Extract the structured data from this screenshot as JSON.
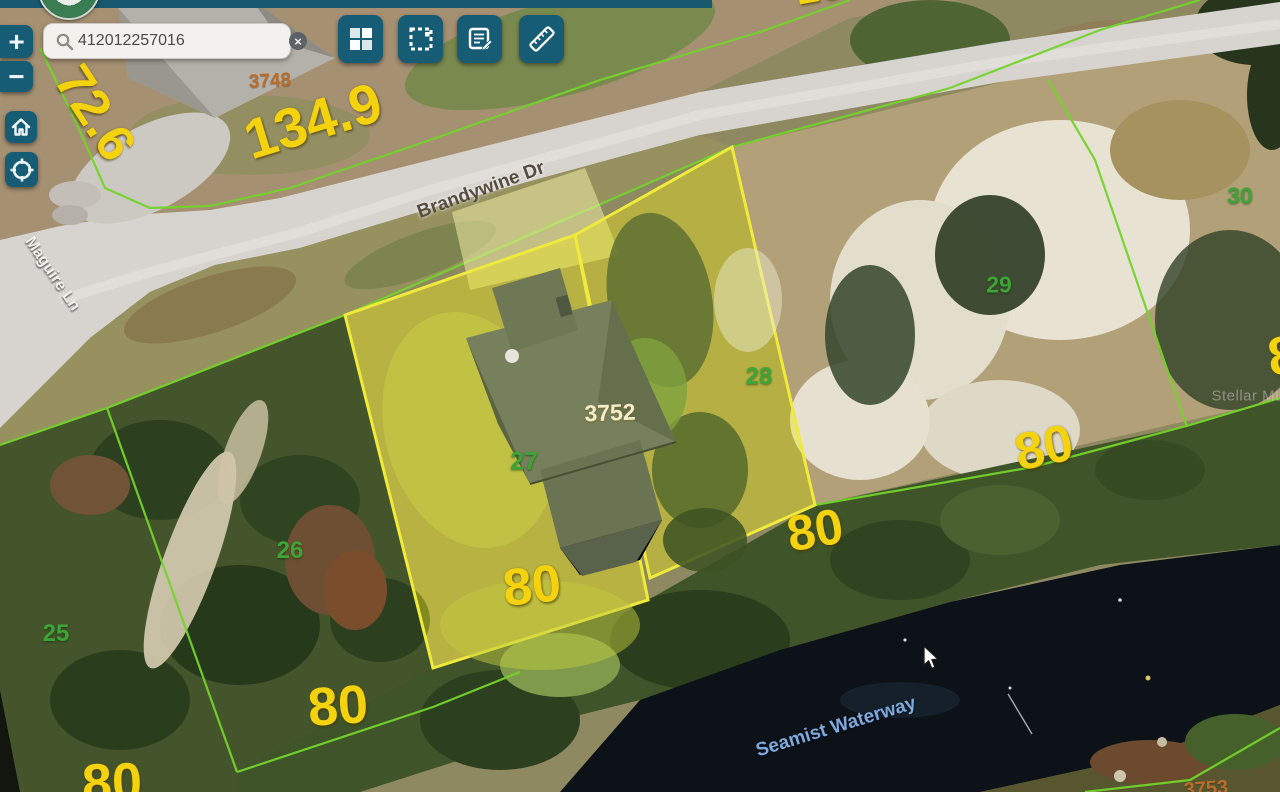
{
  "ui": {
    "search": {
      "value": "412012257016",
      "placeholder": "",
      "clear_glyph": "×"
    },
    "map_controls": {
      "zoom_in": "+",
      "zoom_out": "−"
    },
    "colors": {
      "accent_teal": "#175c75",
      "parcel_line_green": "#74d32c",
      "selection_yellow": "#f0ea3c",
      "dimension_yellow": "#f4d20d"
    }
  },
  "map": {
    "selected_parcel_id": "3752",
    "annotations": [
      {
        "name": "dimension-72-6",
        "text": "72.6",
        "x": 95,
        "y": 113,
        "rot": 57,
        "size": 52,
        "cls": "dim"
      },
      {
        "name": "dimension-134-9",
        "text": "134.9",
        "x": 313,
        "y": 121,
        "rot": -17,
        "size": 56,
        "cls": "dim"
      },
      {
        "name": "dimension-16-partial",
        "text": "16",
        "x": 818,
        "y": -13,
        "rot": -10,
        "size": 42,
        "cls": "dim"
      },
      {
        "name": "parcel-id-3748",
        "text": "3748",
        "x": 270,
        "y": 81,
        "rot": -3,
        "size": 19,
        "cls": "pid"
      },
      {
        "name": "street-brandywine-dr",
        "text": "Brandywine Dr",
        "x": 481,
        "y": 190,
        "rot": -20,
        "size": 19,
        "cls": "street"
      },
      {
        "name": "street-maguire-ln",
        "text": "Maguire Ln",
        "x": 52,
        "y": 274,
        "rot": 56,
        "size": 16,
        "cls": "street-white"
      },
      {
        "name": "lot-25",
        "text": "25",
        "x": 56,
        "y": 634,
        "rot": 0,
        "size": 24,
        "cls": "lot"
      },
      {
        "name": "lot-26",
        "text": "26",
        "x": 290,
        "y": 551,
        "rot": 0,
        "size": 24,
        "cls": "lot"
      },
      {
        "name": "lot-27",
        "text": "27",
        "x": 524,
        "y": 462,
        "rot": 0,
        "size": 25,
        "cls": "lot"
      },
      {
        "name": "lot-28",
        "text": "28",
        "x": 759,
        "y": 377,
        "rot": 0,
        "size": 24,
        "cls": "lot"
      },
      {
        "name": "lot-29",
        "text": "29",
        "x": 999,
        "y": 285,
        "rot": 0,
        "size": 23,
        "cls": "lot"
      },
      {
        "name": "lot-30",
        "text": "30",
        "x": 1240,
        "y": 196,
        "rot": 0,
        "size": 23,
        "cls": "lot"
      },
      {
        "name": "parcel-id-3752",
        "text": "3752",
        "x": 610,
        "y": 413,
        "rot": -2,
        "size": 23,
        "cls": "pid-light"
      },
      {
        "name": "dimension-80-lot26",
        "text": "80",
        "x": 338,
        "y": 706,
        "rot": -4,
        "size": 54,
        "cls": "dim"
      },
      {
        "name": "dimension-80-lot25",
        "text": "80",
        "x": 112,
        "y": 783,
        "rot": -2,
        "size": 54,
        "cls": "dim"
      },
      {
        "name": "dimension-80-lot27",
        "text": "80",
        "x": 532,
        "y": 586,
        "rot": -6,
        "size": 52,
        "cls": "dim"
      },
      {
        "name": "dimension-80-lot28",
        "text": "80",
        "x": 815,
        "y": 530,
        "rot": -10,
        "size": 50,
        "cls": "dim"
      },
      {
        "name": "dimension-80-rear",
        "text": "80",
        "x": 1044,
        "y": 448,
        "rot": -12,
        "size": 52,
        "cls": "dim"
      },
      {
        "name": "dimension-8-partial",
        "text": "8",
        "x": 1283,
        "y": 356,
        "rot": -8,
        "size": 54,
        "cls": "dim"
      },
      {
        "name": "parcel-id-3753",
        "text": "3753",
        "x": 1206,
        "y": 789,
        "rot": -4,
        "size": 20,
        "cls": "pid"
      },
      {
        "name": "waterway-seamist",
        "text": "Seamist Waterway",
        "x": 836,
        "y": 727,
        "rot": -17,
        "size": 19,
        "cls": "water"
      },
      {
        "name": "watermark-stellar-mls",
        "text": "Stellar MLS",
        "x": 1253,
        "y": 396,
        "rot": 0,
        "size": 15,
        "cls": "wm"
      }
    ]
  }
}
